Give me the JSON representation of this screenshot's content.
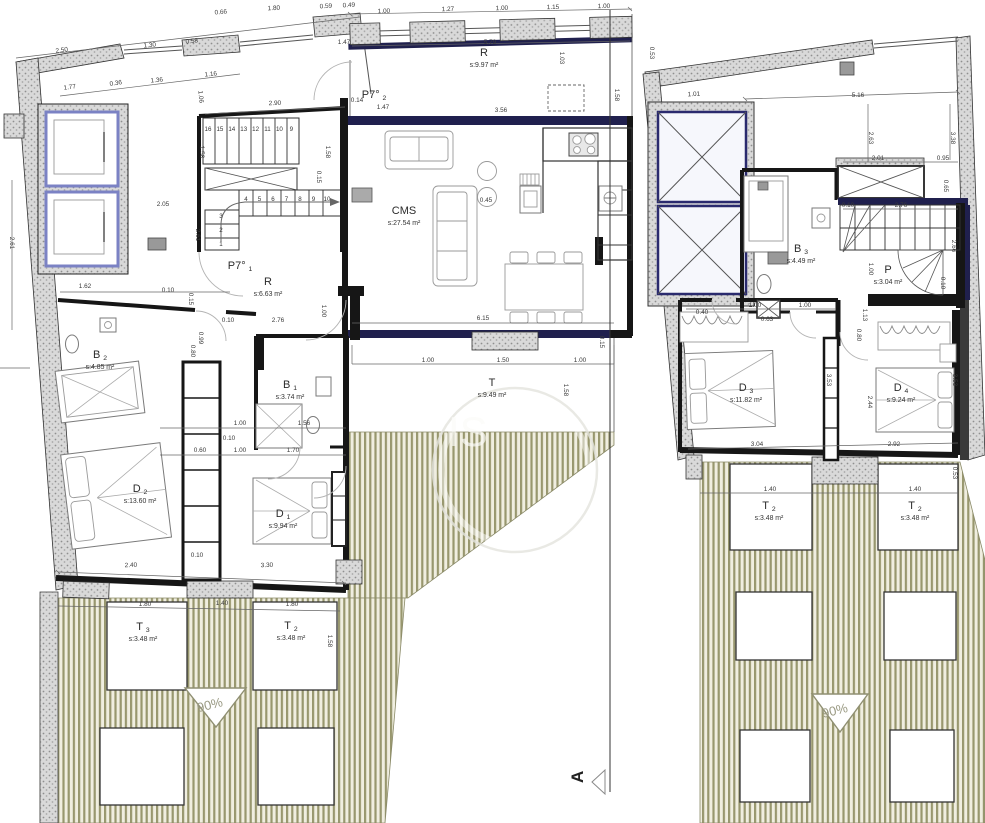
{
  "markers": {
    "section": "A",
    "slope": "90%"
  },
  "watermark": {
    "text": "IS"
  },
  "colors": {
    "wall": "#161616",
    "accent_navy": "#20204e",
    "elevator_blue": "#7b82c4",
    "hatch_stripe": "#98976e",
    "hatch_background": "#f0eee0",
    "stipple_gray": "#d9d9d9",
    "dim_text": "#3a3a3a"
  },
  "stairs": {
    "left_upper": [
      "16",
      "15",
      "14",
      "13",
      "12",
      "11",
      "10",
      "9"
    ],
    "left_lower_a": [
      "1",
      "2",
      "3"
    ],
    "left_lower_b": [
      "4",
      "5",
      "6",
      "7",
      "8",
      "9",
      "10"
    ]
  },
  "rooms": [
    {
      "unit": "left",
      "name": "R",
      "sub": "",
      "area": "s:9.97 m²",
      "x": 484,
      "y": 56
    },
    {
      "unit": "left",
      "name": "P7°",
      "sub": "2",
      "area": "",
      "x": 374,
      "y": 98
    },
    {
      "unit": "left",
      "name": "CMS",
      "sub": "",
      "area": "s:27.54 m²",
      "x": 404,
      "y": 214
    },
    {
      "unit": "left",
      "name": "P7°",
      "sub": "1",
      "area": "",
      "x": 240,
      "y": 269
    },
    {
      "unit": "left",
      "name": "R",
      "sub": "",
      "area": "s:6.63 m²",
      "x": 268,
      "y": 285
    },
    {
      "unit": "left",
      "name": "B",
      "sub": "2",
      "area": "s:4.85 m²",
      "x": 100,
      "y": 358
    },
    {
      "unit": "left",
      "name": "B",
      "sub": "1",
      "area": "s:3.74 m²",
      "x": 290,
      "y": 388
    },
    {
      "unit": "left",
      "name": "D",
      "sub": "2",
      "area": "s:13.60 m²",
      "x": 140,
      "y": 492
    },
    {
      "unit": "left",
      "name": "D",
      "sub": "1",
      "area": "s:9.94 m²",
      "x": 283,
      "y": 517
    },
    {
      "unit": "left",
      "name": "T",
      "sub": "",
      "area": "s:9.49 m²",
      "x": 492,
      "y": 386
    },
    {
      "unit": "left",
      "name": "T",
      "sub": "3",
      "area": "s:3.48 m²",
      "x": 143,
      "y": 630
    },
    {
      "unit": "left",
      "name": "T",
      "sub": "2",
      "area": "s:3.48 m²",
      "x": 291,
      "y": 629
    },
    {
      "unit": "right",
      "name": "B",
      "sub": "3",
      "area": "s:4.49 m²",
      "x": 801,
      "y": 252
    },
    {
      "unit": "right",
      "name": "P",
      "sub": "",
      "area": "s:3.04 m²",
      "x": 888,
      "y": 273
    },
    {
      "unit": "right",
      "name": "D",
      "sub": "3",
      "area": "s:11.82 m²",
      "x": 746,
      "y": 391
    },
    {
      "unit": "right",
      "name": "D",
      "sub": "4",
      "area": "s:9.24 m²",
      "x": 901,
      "y": 391
    },
    {
      "unit": "right",
      "name": "T",
      "sub": "2",
      "area": "s:3.48 m²",
      "x": 769,
      "y": 509
    },
    {
      "unit": "right",
      "name": "T",
      "sub": "2",
      "area": "s:3.48 m²",
      "x": 915,
      "y": 509
    }
  ],
  "dimensions": [
    {
      "t": "2.50",
      "x": 62,
      "y": 52,
      "r": -8
    },
    {
      "t": "1.77",
      "x": 70,
      "y": 89,
      "r": -8
    },
    {
      "t": "0.36",
      "x": 116,
      "y": 85,
      "r": -8
    },
    {
      "t": "1.30",
      "x": 150,
      "y": 47,
      "r": -6
    },
    {
      "t": "1.36",
      "x": 157,
      "y": 82,
      "r": -6
    },
    {
      "t": "0.58",
      "x": 192,
      "y": 43,
      "r": -6
    },
    {
      "t": "1.16",
      "x": 211,
      "y": 76,
      "r": -6
    },
    {
      "t": "1.06",
      "x": 199,
      "y": 97,
      "r": 84
    },
    {
      "t": "0.66",
      "x": 221,
      "y": 14,
      "r": -5
    },
    {
      "t": "1.80",
      "x": 274,
      "y": 10,
      "r": -4
    },
    {
      "t": "0.59",
      "x": 326,
      "y": 8,
      "r": -3
    },
    {
      "t": "0.49",
      "x": 349,
      "y": 7,
      "r": -3
    },
    {
      "t": "1.47",
      "x": 344,
      "y": 44,
      "r": 0
    },
    {
      "t": "2.90",
      "x": 275,
      "y": 105,
      "r": -2
    },
    {
      "t": "1.00",
      "x": 384,
      "y": 13,
      "r": -2
    },
    {
      "t": "1.27",
      "x": 448,
      "y": 11,
      "r": -2
    },
    {
      "t": "1.00",
      "x": 502,
      "y": 10,
      "r": -2
    },
    {
      "t": "1.15",
      "x": 553,
      "y": 9,
      "r": -1
    },
    {
      "t": "1.00",
      "x": 604,
      "y": 8,
      "r": -1
    },
    {
      "t": "5.79",
      "x": 490,
      "y": 44,
      "r": 0
    },
    {
      "t": "1.03",
      "x": 560,
      "y": 58,
      "r": 90
    },
    {
      "t": "1.58",
      "x": 615,
      "y": 95,
      "r": 90
    },
    {
      "t": "0.53",
      "x": 650,
      "y": 53,
      "r": 90
    },
    {
      "t": "0.14",
      "x": 357,
      "y": 102,
      "r": 0
    },
    {
      "t": "1.47",
      "x": 383,
      "y": 109,
      "r": 0
    },
    {
      "t": "3.56",
      "x": 501,
      "y": 112,
      "r": 0
    },
    {
      "t": "1.58",
      "x": 200,
      "y": 152,
      "r": 90
    },
    {
      "t": "1.58",
      "x": 326,
      "y": 152,
      "r": 90
    },
    {
      "t": "0.15",
      "x": 317,
      "y": 177,
      "r": 90
    },
    {
      "t": "2.61",
      "x": 196,
      "y": 235,
      "r": 90
    },
    {
      "t": "2.61",
      "x": 10,
      "y": 243,
      "r": 90
    },
    {
      "t": "2.05",
      "x": 163,
      "y": 206,
      "r": 0
    },
    {
      "t": "1.62",
      "x": 85,
      "y": 288,
      "r": 0
    },
    {
      "t": "0.10",
      "x": 168,
      "y": 292,
      "r": 0
    },
    {
      "t": "0.15",
      "x": 189,
      "y": 299,
      "r": 90
    },
    {
      "t": "0.99",
      "x": 199,
      "y": 338,
      "r": 90
    },
    {
      "t": "0.80",
      "x": 191,
      "y": 351,
      "r": 90
    },
    {
      "t": "0.10",
      "x": 228,
      "y": 322,
      "r": 0
    },
    {
      "t": "2.76",
      "x": 278,
      "y": 322,
      "r": 0
    },
    {
      "t": "1.00",
      "x": 322,
      "y": 311,
      "r": 90
    },
    {
      "t": "6.15",
      "x": 483,
      "y": 320,
      "r": 0
    },
    {
      "t": "0.45",
      "x": 486,
      "y": 202,
      "r": 0
    },
    {
      "t": "1.00",
      "x": 428,
      "y": 362,
      "r": 0
    },
    {
      "t": "1.50",
      "x": 503,
      "y": 362,
      "r": 0
    },
    {
      "t": "1.00",
      "x": 580,
      "y": 362,
      "r": 0
    },
    {
      "t": "1.58",
      "x": 564,
      "y": 390,
      "r": 90
    },
    {
      "t": "0.15",
      "x": 600,
      "y": 342,
      "r": 90
    },
    {
      "t": "1.00",
      "x": 240,
      "y": 425,
      "r": 0
    },
    {
      "t": "1.56",
      "x": 304,
      "y": 425,
      "r": 0
    },
    {
      "t": "0.10",
      "x": 229,
      "y": 440,
      "r": 0
    },
    {
      "t": "0.60",
      "x": 200,
      "y": 452,
      "r": 0
    },
    {
      "t": "1.00",
      "x": 240,
      "y": 452,
      "r": 0
    },
    {
      "t": "1.70",
      "x": 293,
      "y": 452,
      "r": 0
    },
    {
      "t": "2.40",
      "x": 131,
      "y": 567,
      "r": -2
    },
    {
      "t": "3.30",
      "x": 267,
      "y": 567,
      "r": -2
    },
    {
      "t": "0.10",
      "x": 197,
      "y": 557,
      "r": 0
    },
    {
      "t": "1.80",
      "x": 145,
      "y": 606,
      "r": 0
    },
    {
      "t": "1.40",
      "x": 222,
      "y": 605,
      "r": 0
    },
    {
      "t": "1.80",
      "x": 292,
      "y": 606,
      "r": 0
    },
    {
      "t": "1.58",
      "x": 328,
      "y": 641,
      "r": 90
    },
    {
      "t": "1.01",
      "x": 694,
      "y": 96,
      "r": -3
    },
    {
      "t": "5.16",
      "x": 858,
      "y": 97,
      "r": 0
    },
    {
      "t": "2.63",
      "x": 869,
      "y": 138,
      "r": 90
    },
    {
      "t": "3.38",
      "x": 951,
      "y": 138,
      "r": 90
    },
    {
      "t": "2.01",
      "x": 878,
      "y": 160,
      "r": 0
    },
    {
      "t": "0.95",
      "x": 943,
      "y": 160,
      "r": 0
    },
    {
      "t": "0.65",
      "x": 944,
      "y": 186,
      "r": 90
    },
    {
      "t": "0.10",
      "x": 848,
      "y": 207,
      "r": 0
    },
    {
      "t": "2.76",
      "x": 901,
      "y": 207,
      "r": 0
    },
    {
      "t": "2.66",
      "x": 952,
      "y": 246,
      "r": 90
    },
    {
      "t": "1.00",
      "x": 869,
      "y": 269,
      "r": 90
    },
    {
      "t": "0.10",
      "x": 941,
      "y": 283,
      "r": 90
    },
    {
      "t": "1.00",
      "x": 755,
      "y": 307,
      "r": 0
    },
    {
      "t": "1.00",
      "x": 805,
      "y": 307,
      "r": 0
    },
    {
      "t": "0.40",
      "x": 702,
      "y": 314,
      "r": 0
    },
    {
      "t": "0.63",
      "x": 767,
      "y": 321,
      "r": 0
    },
    {
      "t": "1.13",
      "x": 863,
      "y": 315,
      "r": 90
    },
    {
      "t": "0.80",
      "x": 857,
      "y": 335,
      "r": 90
    },
    {
      "t": "3.53",
      "x": 827,
      "y": 380,
      "r": 90
    },
    {
      "t": "2.44",
      "x": 868,
      "y": 402,
      "r": 90
    },
    {
      "t": "3.53",
      "x": 953,
      "y": 380,
      "r": 90
    },
    {
      "t": "3.04",
      "x": 757,
      "y": 446,
      "r": 0
    },
    {
      "t": "2.92",
      "x": 894,
      "y": 446,
      "r": 0
    },
    {
      "t": "1.40",
      "x": 770,
      "y": 491,
      "r": 0
    },
    {
      "t": "1.40",
      "x": 915,
      "y": 491,
      "r": 0
    },
    {
      "t": "0.53",
      "x": 953,
      "y": 473,
      "r": 90
    }
  ]
}
